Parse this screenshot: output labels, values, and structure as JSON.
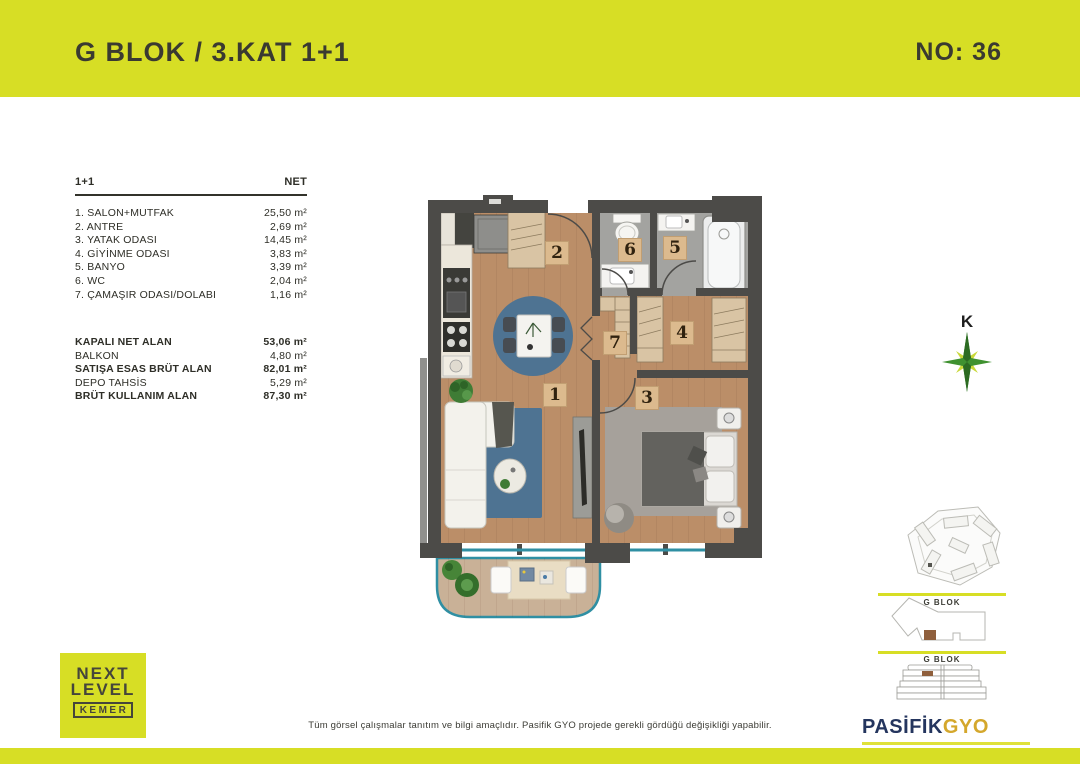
{
  "header": {
    "title": "G BLOK / 3.KAT 1+1",
    "unit_no": "NO: 36"
  },
  "colors": {
    "accent_green": "#d7de25",
    "wall_dark": "#4c4b48",
    "wood_floor": "#bb8e68",
    "tile_gray": "#a3a3a0",
    "rug_blue": "#4e7392",
    "balcony_deck": "#c9b197",
    "glass_teal": "#2f8fa3",
    "unit_highlight": "#8f5f3c"
  },
  "area_table": {
    "type_label": "1+1",
    "net_label": "NET",
    "rows": [
      {
        "name": "1. SALON+MUTFAK",
        "value": "25,50 m²"
      },
      {
        "name": "2. ANTRE",
        "value": "2,69 m²"
      },
      {
        "name": "3. YATAK ODASI",
        "value": "14,45 m²"
      },
      {
        "name": "4. GİYİNME ODASI",
        "value": "3,83 m²"
      },
      {
        "name": "5. BANYO",
        "value": "3,39 m²"
      },
      {
        "name": "6. WC",
        "value": "2,04 m²"
      },
      {
        "name": "7. ÇAMAŞIR ODASI/DOLABI",
        "value": "1,16 m²"
      }
    ]
  },
  "summary": {
    "rows": [
      {
        "name": "KAPALI NET ALAN",
        "value": "53,06 m²"
      },
      {
        "name": "BALKON",
        "value": "4,80 m²"
      },
      {
        "name": "SATIŞA ESAS BRÜT ALAN",
        "value": "82,01 m²"
      },
      {
        "name": "DEPO TAHSİS",
        "value": "5,29 m²"
      },
      {
        "name": "BRÜT KULLANIM ALAN",
        "value": "87,30 m²"
      }
    ]
  },
  "floorplan": {
    "labels": [
      "1",
      "2",
      "3",
      "4",
      "5",
      "6",
      "7"
    ]
  },
  "compass": {
    "north_label": "K"
  },
  "side_panel": {
    "floor_diagram_title": "G BLOK",
    "elevation_diagram_title": "G BLOK"
  },
  "footer": {
    "disclaimer": "Tüm görsel çalışmalar tanıtım ve bilgi amaçlıdır.  Pasifik GYO projede gerekli gördüğü değişikliği yapabilir.",
    "logo": {
      "line1": "NEXT",
      "line2": "LEVEL",
      "line3": "KEMER"
    },
    "publisher": {
      "name": "PASİFİK",
      "suffix": "GYO"
    }
  }
}
